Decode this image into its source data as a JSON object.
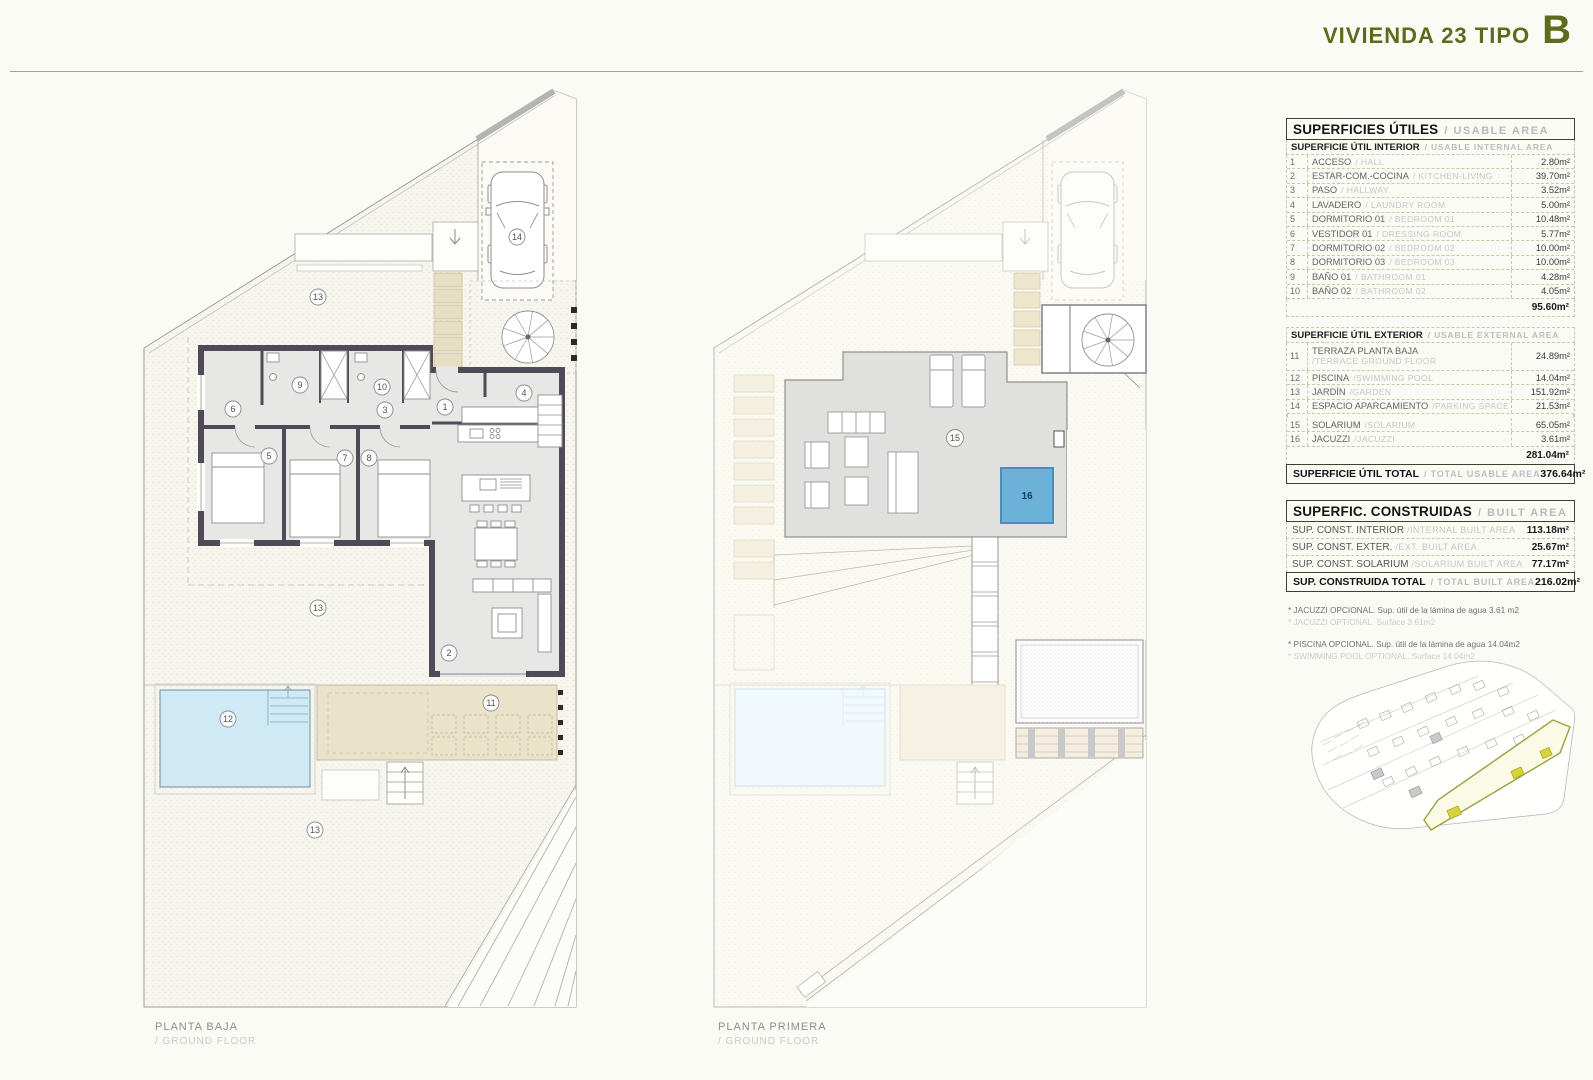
{
  "header": {
    "title": "VIVIENDA 23 TIPO",
    "letter": "B"
  },
  "colors": {
    "accent": "#5c6b1c",
    "wall": "#4e4a57",
    "pool": "#cfe9f5",
    "jacuzzi": "#6cb2d8",
    "terrace": "#eae3c9",
    "khaki_border": "#cbc9a2",
    "site_highlight": "#96a33c"
  },
  "plans": {
    "ground": {
      "title_es": "PLANTA BAJA",
      "title_en": "/ GROUND FLOOR",
      "numbers": {
        "garden_top": "13",
        "parking": "14",
        "bath_01": "9",
        "bath_02": "10",
        "dressing": "6",
        "hallway": "3",
        "hall": "1",
        "laundry": "4",
        "bedroom_01": "5",
        "bedroom_02": "7",
        "bedroom_03": "8",
        "living": "2",
        "garden_mid": "13",
        "pool": "12",
        "terrace": "11",
        "garden_bottom": "13"
      }
    },
    "first": {
      "title_es": "PLANTA PRIMERA",
      "title_en": "/ GROUND FLOOR",
      "numbers": {
        "solarium": "15",
        "jacuzzi": "16"
      }
    }
  },
  "tables": {
    "usable": {
      "title_es": "SUPERFICIES ÚTILES",
      "title_en": "/ USABLE AREA",
      "interior_header_es": "SUPERFICIE ÚTIL INTERIOR",
      "interior_header_en": "/ USABLE INTERNAL AREA",
      "interior_rows": [
        {
          "num": "1",
          "es": "ACCESO",
          "en": "/ HALL",
          "value": "2.80m²"
        },
        {
          "num": "2",
          "es": "ESTAR-COM.-COCINA",
          "en": "/ KITCHEN-LIVING",
          "value": "39.70m²"
        },
        {
          "num": "3",
          "es": "PASO",
          "en": "/ HALLWAY",
          "value": "3.52m²"
        },
        {
          "num": "4",
          "es": "LAVADERO",
          "en": "/ LAUNDRY ROOM",
          "value": "5.00m²"
        },
        {
          "num": "5",
          "es": "DORMITORIO 01",
          "en": "/ BEDROOM 01",
          "value": "10.48m²"
        },
        {
          "num": "6",
          "es": "VESTIDOR 01",
          "en": "/ DRESSING ROOM",
          "value": "5.77m²"
        },
        {
          "num": "7",
          "es": "DORMITORIO 02",
          "en": "/ BEDROOM 02",
          "value": "10.00m²"
        },
        {
          "num": "8",
          "es": "DORMITORIO 03",
          "en": "/ BEDROOM 03",
          "value": "10.00m²"
        },
        {
          "num": "9",
          "es": "BAÑO 01",
          "en": "/ BATHROOM 01",
          "value": "4.28m²"
        },
        {
          "num": "10",
          "es": "BAÑO 02",
          "en": "/ BATHROOM 02",
          "value": "4.05m²"
        }
      ],
      "interior_subtotal": "95.60m²",
      "exterior_header_es": "SUPERFICIE ÚTIL EXTERIOR",
      "exterior_header_en": "/ USABLE EXTERNAL AREA",
      "exterior_rows": [
        {
          "num": "11",
          "es": "TERRAZA PLANTA BAJA",
          "en": "/TERRACE GROUND FLOOR",
          "value": "24.89m²"
        },
        {
          "num": "12",
          "es": "PISCINA",
          "en": "/SWIMMING POOL",
          "value": "14.04m²"
        },
        {
          "num": "13",
          "es": "JARDÍN",
          "en": "/GARDEN",
          "value": "151.92m²"
        },
        {
          "num": "14",
          "es": "ESPACIO APARCAMIENTO",
          "en": "/PARKING SPACE",
          "value": "21.53m²"
        },
        {
          "num": "15",
          "es": "SOLARIUM",
          "en": "/SOLARIUM",
          "value": "65.05m²"
        },
        {
          "num": "16",
          "es": "JACUZZI",
          "en": "/JACUZZI",
          "value": "3.61m²"
        }
      ],
      "exterior_subtotal": "281.04m²",
      "total_es": "SUPERFICIE ÚTIL TOTAL",
      "total_en": "/ TOTAL USABLE AREA",
      "total_value": "376.64m²"
    },
    "built": {
      "title_es": "SUPERFIC. CONSTRUIDAS",
      "title_en": "/ BUILT AREA",
      "rows": [
        {
          "es": "SUP. CONST. INTERIOR",
          "en": "/INTERNAL BUILT AREA",
          "value": "113.18m²"
        },
        {
          "es": "SUP. CONST. EXTER.",
          "en": "/EXT. BUILT AREA",
          "value": "25.67m²"
        },
        {
          "es": "SUP. CONST. SOLARIUM",
          "en": "/SOLARIUM BUILT AREA",
          "value": "77.17m²"
        }
      ],
      "total_es": "SUP. CONSTRUIDA TOTAL",
      "total_en": "/ TOTAL BUILT AREA",
      "total_value": "216.02m²"
    }
  },
  "footnotes": [
    {
      "es": "* JACUZZI OPCIONAL. Sup. útil de la lámina de agua 3.61 m2",
      "en": "* JACUZZI OPTIONAL. Surface 3.61m2"
    },
    {
      "es": "* PISCINA OPCIONAL. Sup. útil de la lámina de agua 14.04m2",
      "en": "* SWIMMING POOL OPTIONAL. Surface 14.04m2"
    }
  ]
}
